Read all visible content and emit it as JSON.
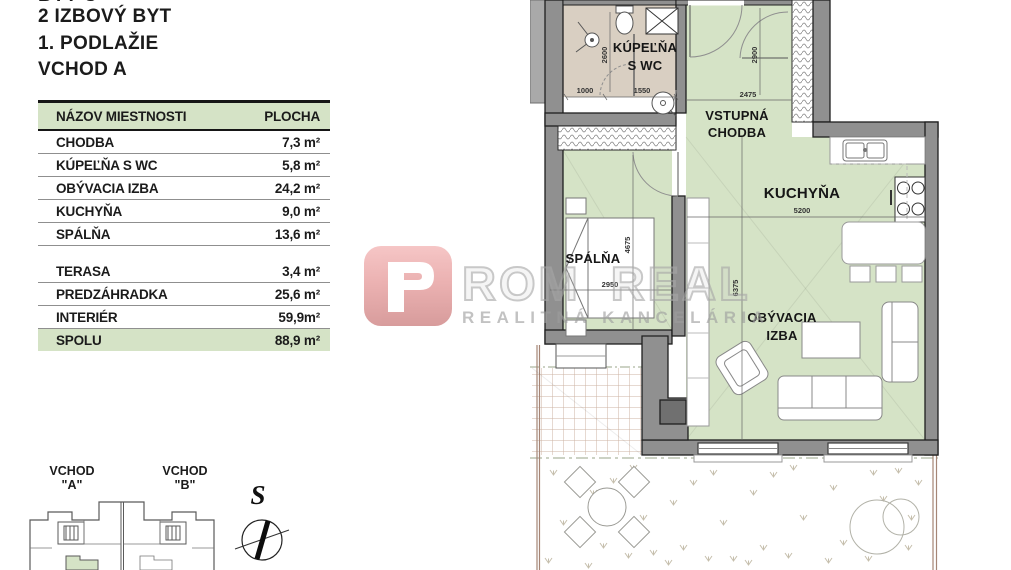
{
  "header": {
    "clipped_line": "BYT C",
    "title": "2 IZBOVÝ BYT",
    "floor": "1. PODLAŽIE",
    "entrance": "VCHOD A"
  },
  "table": {
    "col_name": "NÁZOV MIESTNOSTI",
    "col_area": "PLOCHA",
    "rows": [
      {
        "name": "CHODBA",
        "area": "7,3 m²"
      },
      {
        "name": "KÚPEĽŇA S WC",
        "area": "5,8 m²"
      },
      {
        "name": "OBÝVACIA IZBA",
        "area": "24,2 m²"
      },
      {
        "name": "KUCHYŇA",
        "area": "9,0 m²"
      },
      {
        "name": "SPÁLŇA",
        "area": "13,6 m²"
      }
    ],
    "summary": [
      {
        "name": "TERASA",
        "area": "3,4 m²"
      },
      {
        "name": "PREDZÁHRADKA",
        "area": "25,6 m²"
      },
      {
        "name": "INTERIÉR",
        "area": "59,9m²"
      },
      {
        "name": "SPOLU",
        "area": "88,9 m²"
      }
    ]
  },
  "logo": {
    "name": "ROM REAL",
    "subtitle": "REALITNÁ KANCELÁRIA"
  },
  "plan": {
    "rooms": {
      "bathroom_l1": "KÚPEĽŇA",
      "bathroom_l2": "S WC",
      "hall_l1": "VSTUPNÁ",
      "hall_l2": "CHODBA",
      "kitchen": "KUCHYŇA",
      "bedroom": "SPÁLŇA",
      "living_l1": "OBÝVACIA",
      "living_l2": "IZBA"
    },
    "dims": {
      "shower_w": "1000",
      "bath_w": "1550",
      "bath_h": "2600",
      "hall_h": "2900",
      "hall_w": "2475",
      "bedroom_h": "4675",
      "bedroom_w": "2950",
      "kitchen_w": "5200",
      "living_h": "6375"
    }
  },
  "minimap": {
    "a_l1": "VCHOD",
    "a_l2": "\"A\"",
    "b_l1": "VCHOD",
    "b_l2": "\"B\""
  },
  "compass": {
    "north": "S"
  },
  "colors": {
    "room_green": "#d5e3c6",
    "bathroom_beige": "#d9cfc2",
    "wall_gray": "#909090",
    "logo_red": "#d9534f"
  }
}
